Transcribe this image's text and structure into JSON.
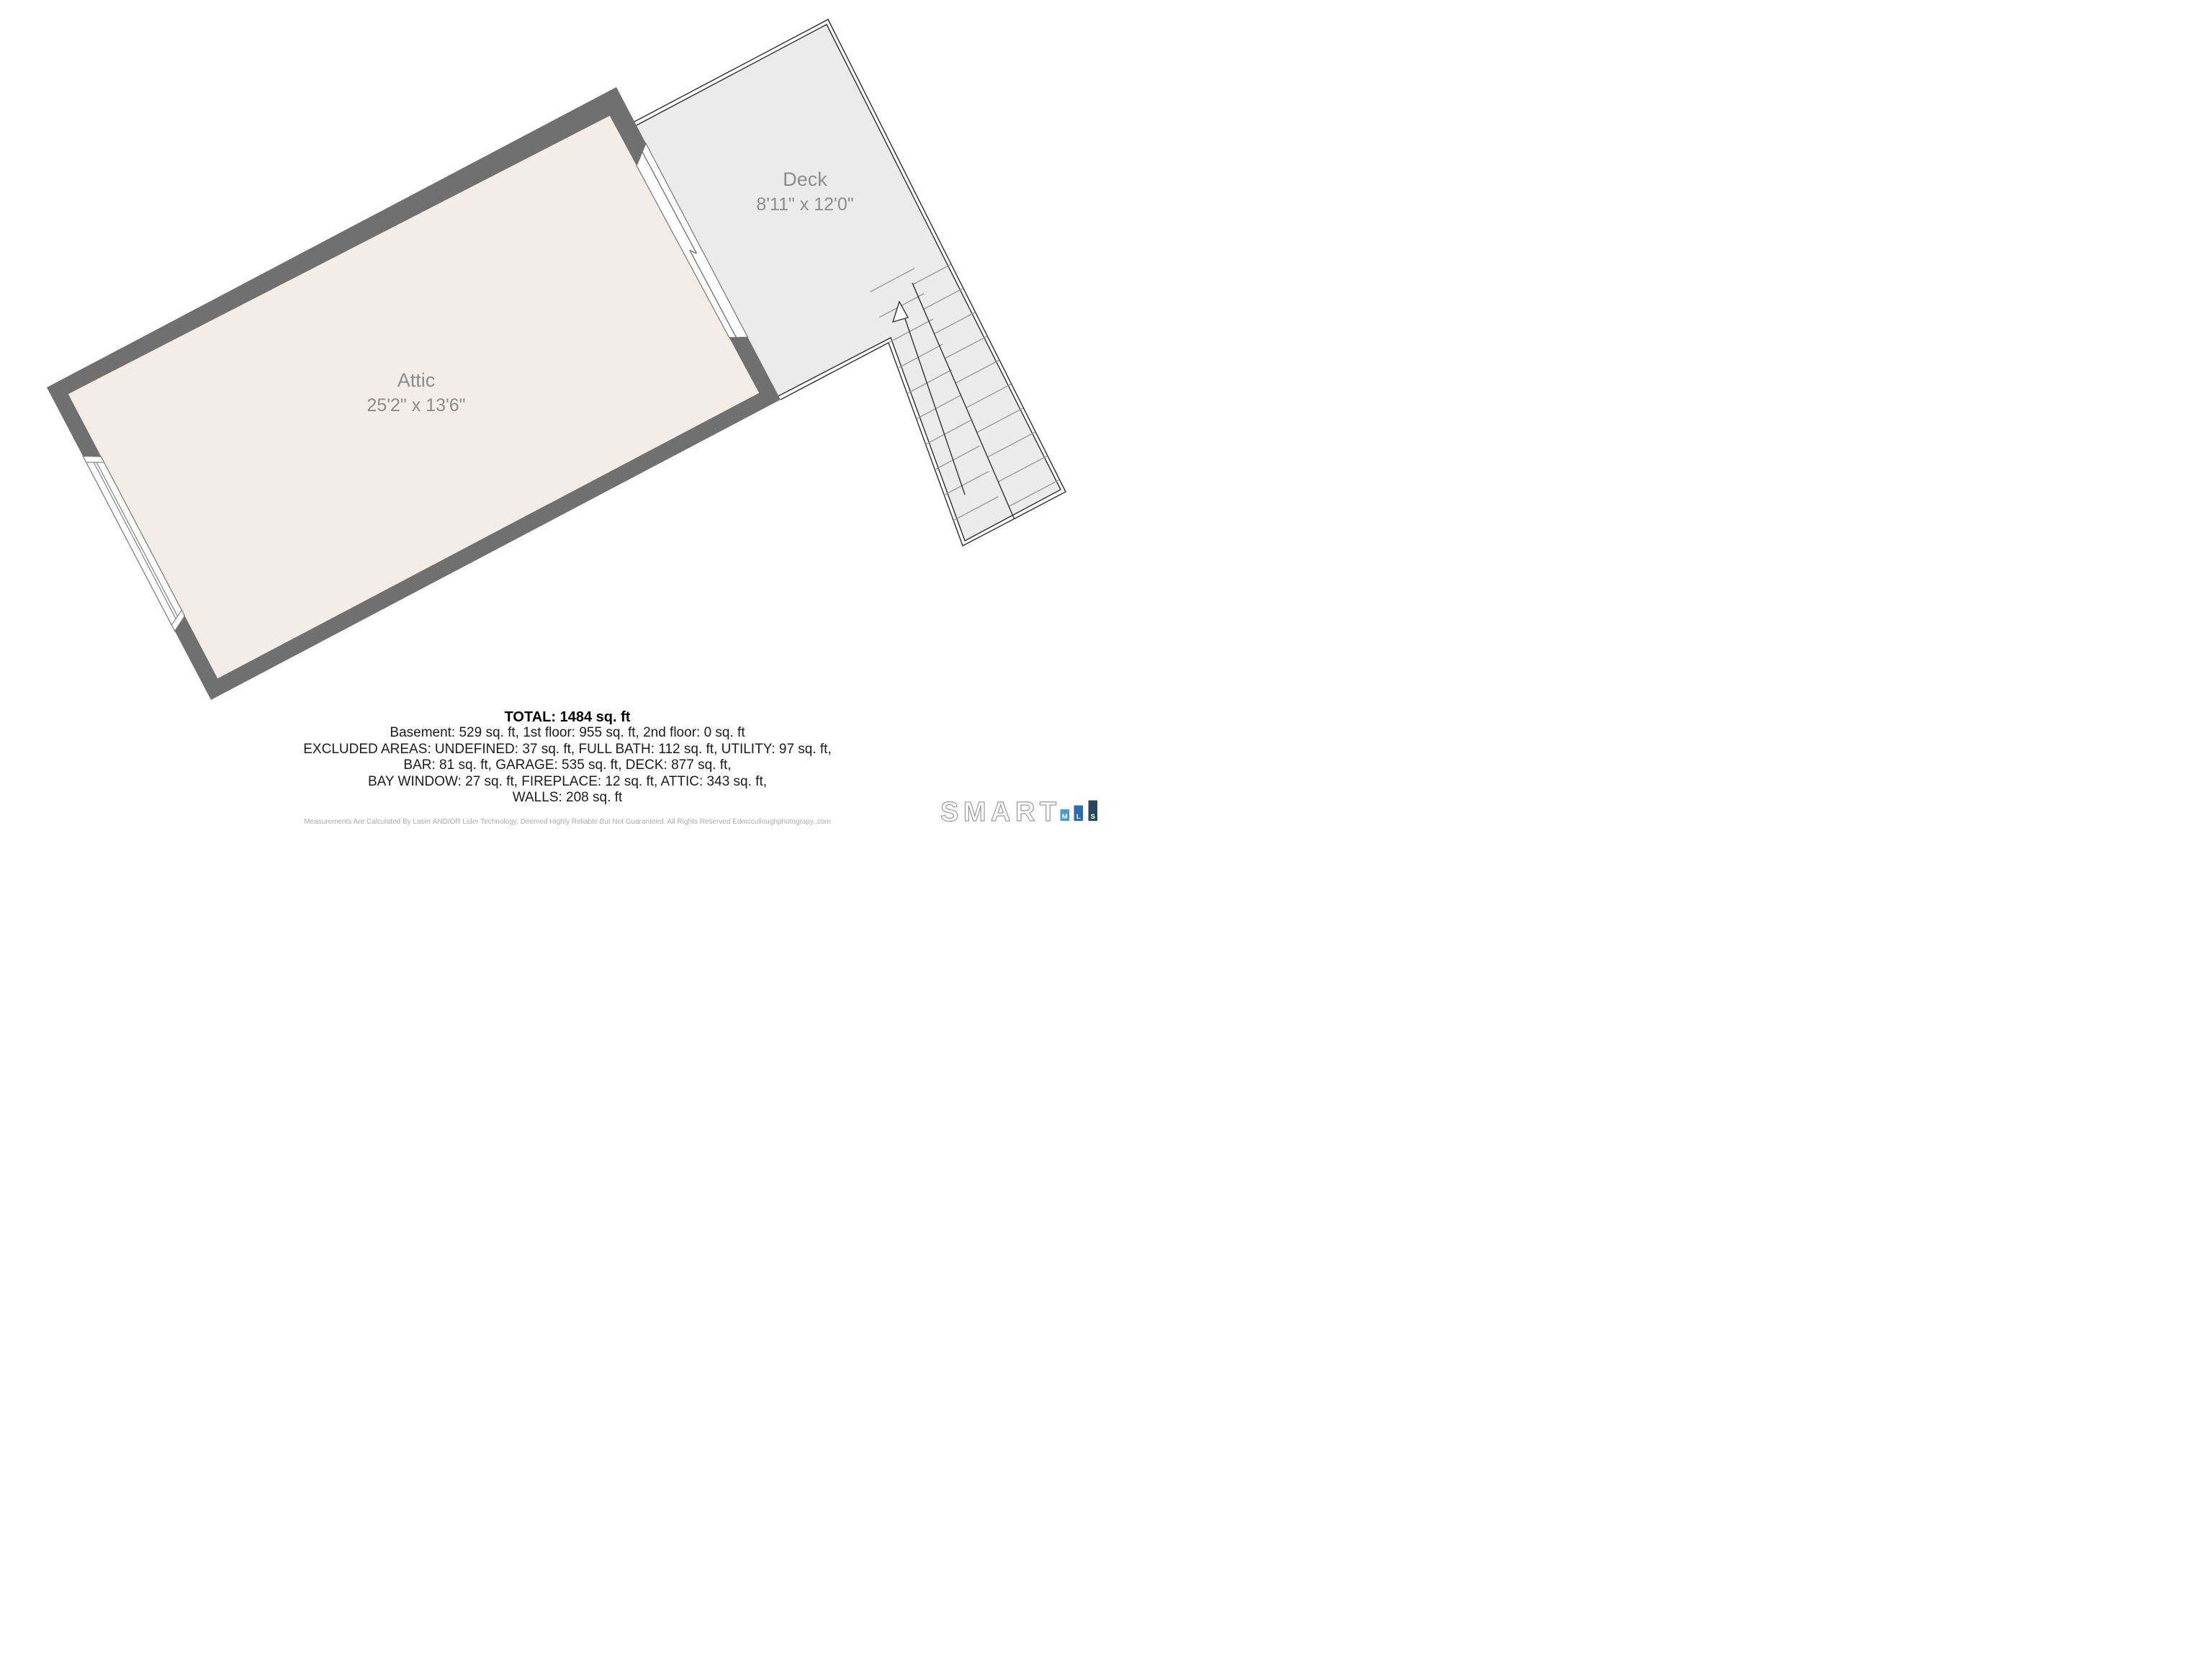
{
  "rooms": {
    "attic": {
      "name": "Attic",
      "dimensions": "25'2\" x 13'6\""
    },
    "deck": {
      "name": "Deck",
      "dimensions": "8'11\" x 12'0\""
    }
  },
  "summary": {
    "total": "TOTAL: 1484 sq. ft",
    "lines": [
      "Basement: 529 sq. ft, 1st floor: 955 sq. ft, 2nd floor: 0 sq. ft",
      "EXCLUDED AREAS: UNDEFINED: 37 sq. ft, FULL BATH: 112 sq. ft, UTILITY: 97 sq. ft,",
      "BAR: 81 sq. ft, GARAGE: 535 sq. ft, DECK: 877 sq. ft,",
      "BAY WINDOW: 27 sq. ft, FIREPLACE: 12 sq. ft, ATTIC: 343 sq. ft,",
      "WALLS: 208 sq. ft"
    ]
  },
  "disclaimer": "Measurements Are Calculated By Laser AND/OR Lider Technology. Deemed Highly Reliable But Not Guaranteed. All Rights Reserved Edmcculloughphotograpy.,com",
  "logo": {
    "brand": "SMART",
    "bars": [
      {
        "label": "M",
        "color": "#429cd8"
      },
      {
        "label": "L",
        "color": "#2a6cb2"
      },
      {
        "label": "S",
        "color": "#27485c"
      }
    ]
  },
  "icons": {
    "stairs_arrow": "up-arrow"
  },
  "colors": {
    "attic_fill": "#f4ede7",
    "wall": "#707070",
    "deck_fill": "#ebebeb",
    "tread": "#9b9b9b",
    "railing": "#2e2e2e",
    "label_text": "#8c8c8c"
  }
}
